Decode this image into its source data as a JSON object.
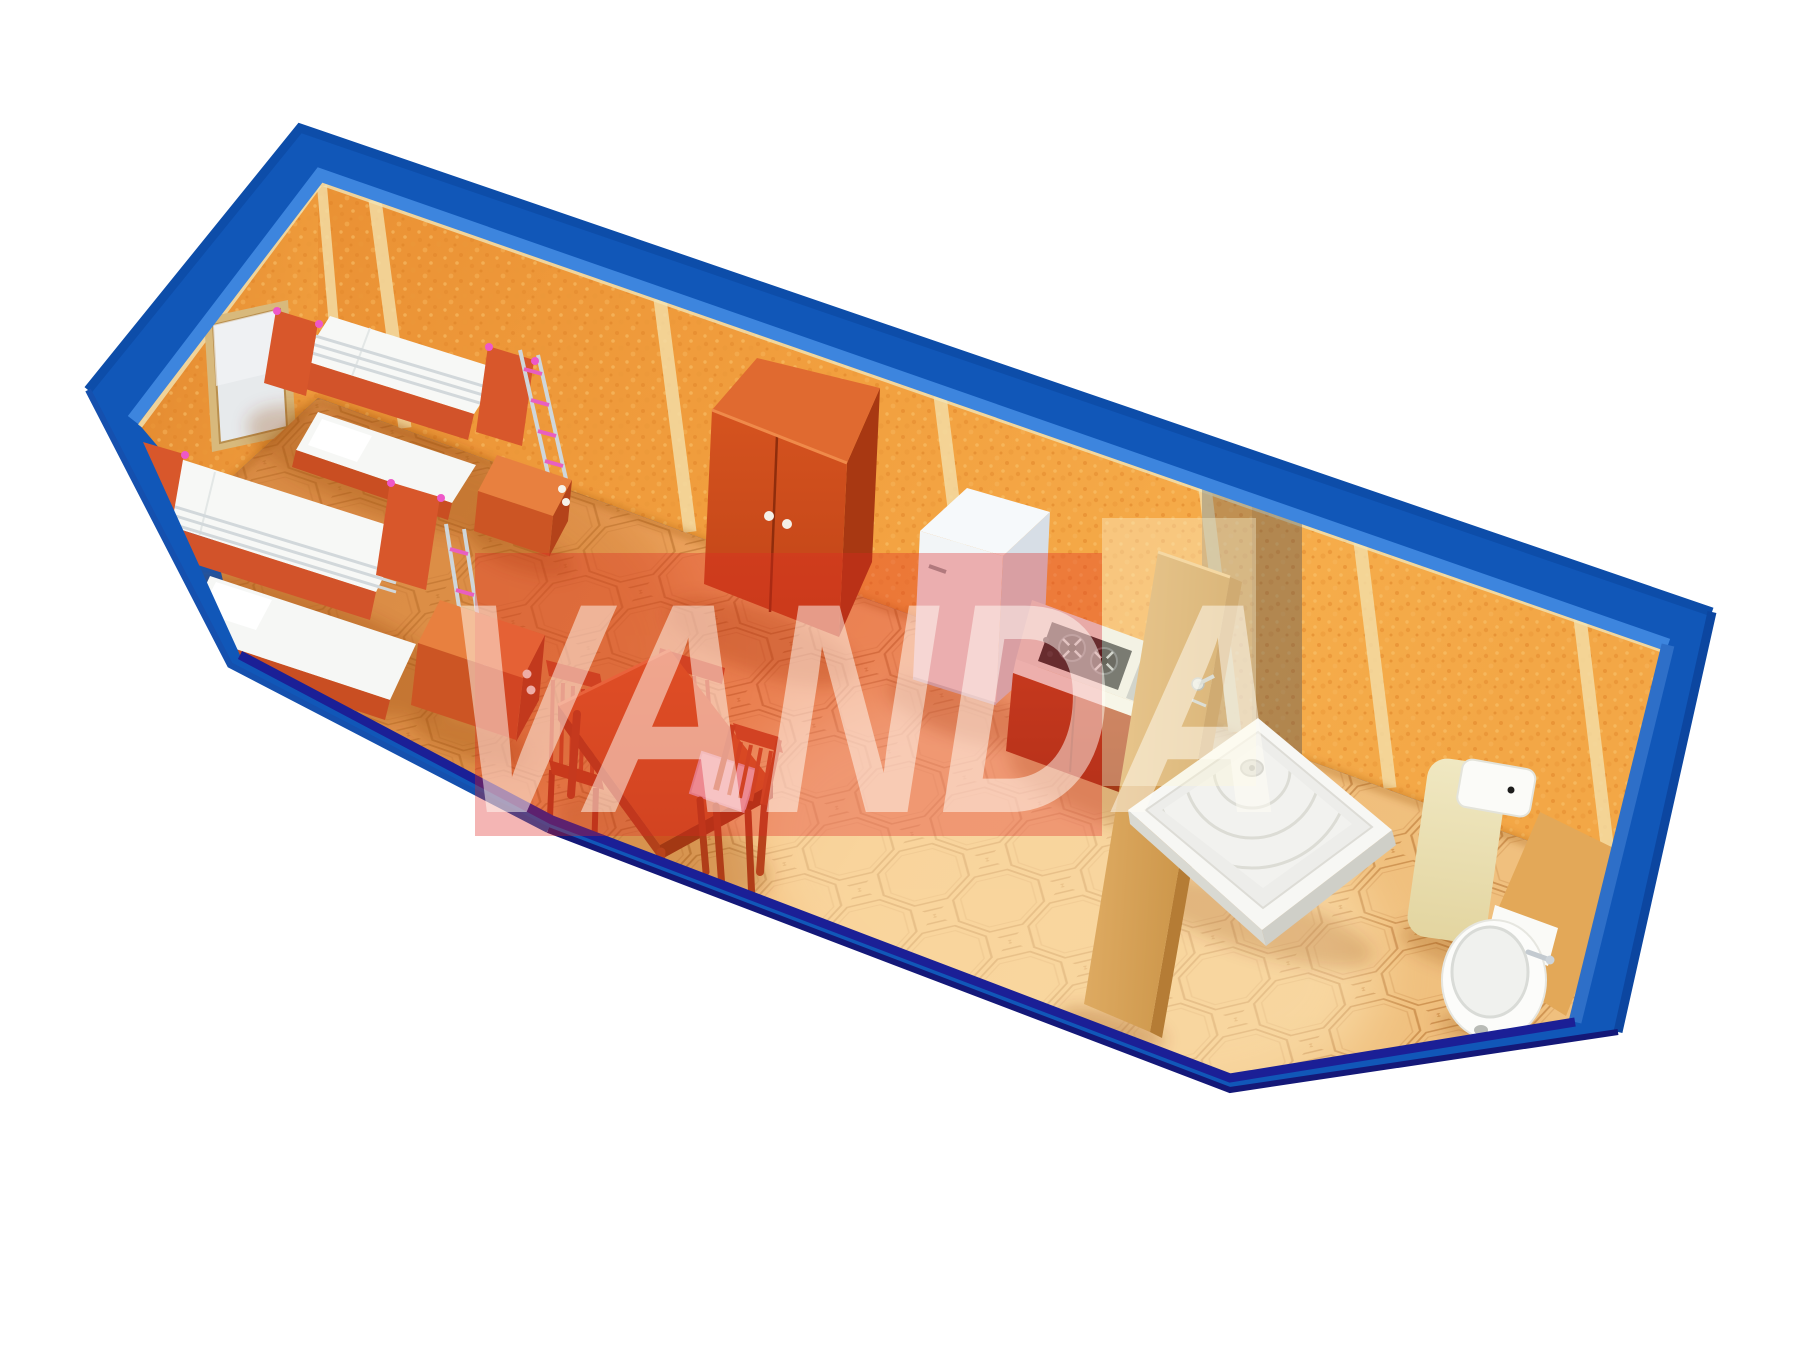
{
  "canvas": {
    "width": 1800,
    "height": 1350,
    "background": "#ffffff"
  },
  "watermark": {
    "text": "VANDA",
    "box_color": "#e02524",
    "box_opacity": 0.34,
    "overlay_box_color": "#fdf6d8",
    "overlay_box_opacity": 0.38,
    "text_color": "#fffdf6",
    "text_opacity": 0.5
  },
  "palette": {
    "frame_blue": "#1157b8",
    "frame_blue_bevel": "#3d85de",
    "frame_navy_edge": "#1b1f96",
    "wall_orange": "#f2a03f",
    "wall_batten_cream": "#f4dca4",
    "floor_tan": "#eda35c",
    "floor_line_brown": "#b06a28",
    "furniture_wood_red": "#d4572a",
    "wardrobe_red": "#c84a1c",
    "door_wood_light": "#d9a855",
    "bedding_white": "#f7f8f6",
    "appliance_white": "#f2f5f7",
    "chrome_gray": "#cfd6da",
    "accent_pink": "#ee58c8",
    "toilet_cream": "#eee4ba",
    "seat_cushion_pink": "#f4bcc8"
  },
  "scene": {
    "description": "Isometric cutaway 3D render of a blue container-house module with orange chipboard walls and octagon-tiled floor",
    "objects": [
      {
        "name": "bunk-bed-back",
        "label": "bunk bed"
      },
      {
        "name": "bunk-bed-front",
        "label": "bunk bed"
      },
      {
        "name": "window",
        "label": "window"
      },
      {
        "name": "nightstand-1",
        "label": "bedside cabinet"
      },
      {
        "name": "nightstand-2",
        "label": "bedside cabinet"
      },
      {
        "name": "wardrobe",
        "label": "two-door wardrobe"
      },
      {
        "name": "dining-table",
        "label": "dining table"
      },
      {
        "name": "chairs",
        "label": "three chairs"
      },
      {
        "name": "refrigerator",
        "label": "refrigerator"
      },
      {
        "name": "cooktop",
        "label": "two-burner hob"
      },
      {
        "name": "kitchen-sink",
        "label": "stainless sink"
      },
      {
        "name": "partition-door",
        "label": "wooden partition door"
      },
      {
        "name": "shower-glass",
        "label": "shower glass screen"
      },
      {
        "name": "shower-tray",
        "label": "shower tray"
      },
      {
        "name": "toilet",
        "label": "toilet"
      },
      {
        "name": "washbasin",
        "label": "washbasin"
      }
    ]
  }
}
